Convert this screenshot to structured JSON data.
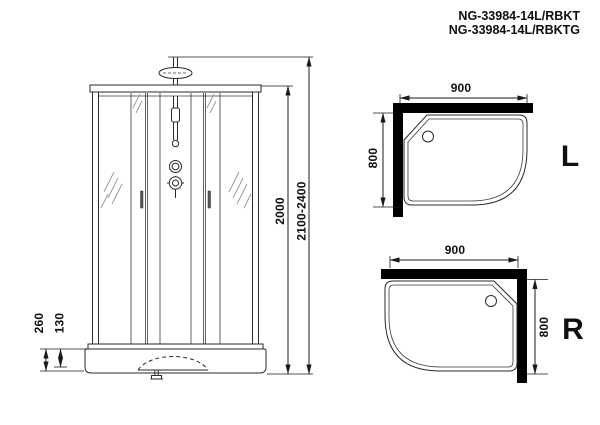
{
  "title": {
    "line1": "NG-33984-14L/RBKT",
    "line2": "NG-33984-14L/RBKTG"
  },
  "elevation": {
    "dim_total_height": "2100-2400",
    "dim_cabin_height": "2000",
    "dim_tray_height": "260",
    "dim_tray_step": "130"
  },
  "plan_left": {
    "label": "L",
    "dim_width": "900",
    "dim_depth": "800"
  },
  "plan_right": {
    "label": "R",
    "dim_width": "900",
    "dim_depth": "800"
  },
  "colors": {
    "line": "#2a2a2a",
    "wall_fill": "#000000",
    "glass_hatch": "#9a9a9a",
    "background": "#ffffff"
  }
}
